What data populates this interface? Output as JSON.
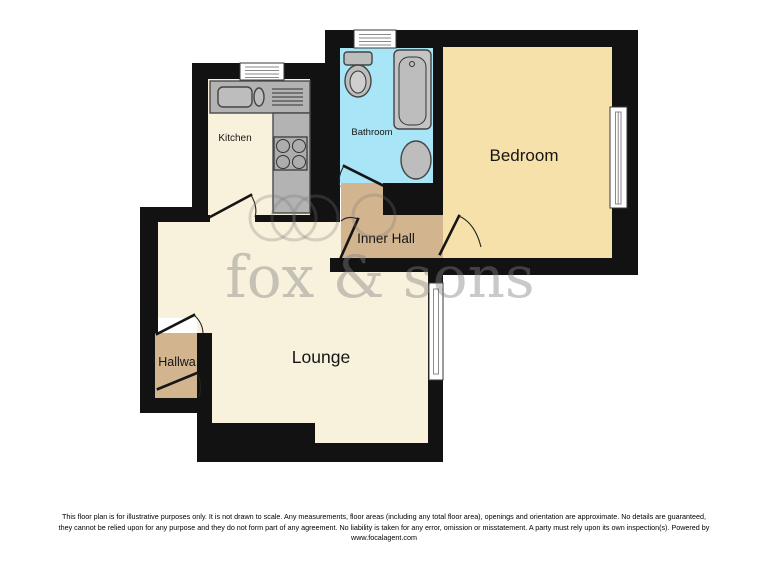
{
  "watermark": {
    "brand": "fox & sons"
  },
  "colors": {
    "wall": "#121212",
    "cream": "#F8F2DC",
    "bedroom_tan": "#F5E1A9",
    "bathroom_blue": "#A8E5F6",
    "hall_brown": "#D2B48E",
    "counter_gray": "#B3B3B3",
    "fixture_gray": "#BDBDBD",
    "watermark_gray": "#808080"
  },
  "rooms": {
    "kitchen": {
      "label": "Kitchen"
    },
    "bathroom": {
      "label": "Bathroom"
    },
    "bedroom": {
      "label": "Bedroom"
    },
    "inner_hall": {
      "label": "Inner Hall"
    },
    "lounge": {
      "label": "Lounge"
    },
    "hallway": {
      "label": "Hallwa"
    }
  },
  "disclaimer": {
    "line1": "This floor plan is for illustrative purposes only. It is not drawn to scale. Any measurements, floor areas (including any total floor area), openings and orientation are approximate. No details are guaranteed,",
    "line2": "they cannot be relied upon for any purpose and they do not form part of any agreement. No liability is taken for any error, omission or misstatement. A party must rely upon its own inspection(s). Powered by",
    "line3": "www.focalagent.com"
  }
}
